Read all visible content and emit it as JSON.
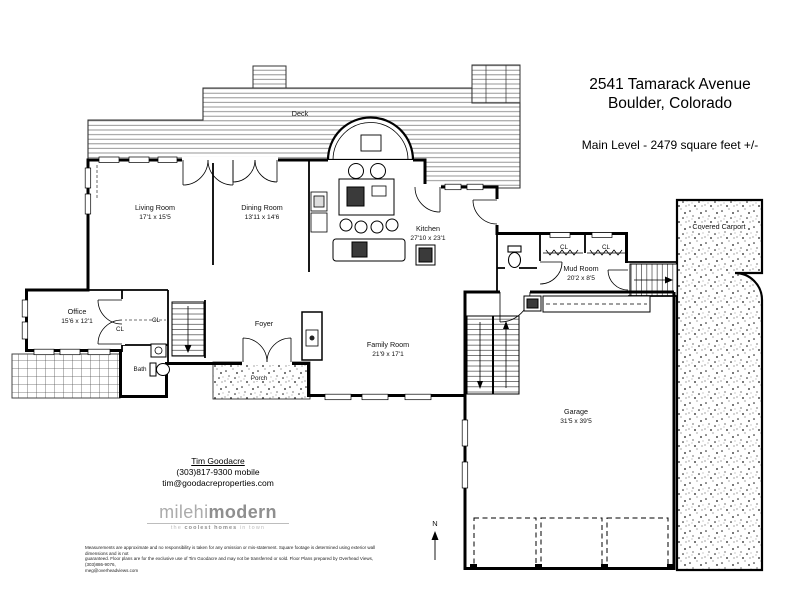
{
  "header": {
    "address_line1": "2541 Tamarack Avenue",
    "address_line2": "Boulder, Colorado",
    "level_label": "Main Level - 2479 square feet +/-"
  },
  "plan": {
    "deck_label": "Deck",
    "porch_label": "Porch",
    "foyer_label": "Foyer",
    "bath_label": "Bath",
    "closet_label": "CL",
    "carport_label": "Covered Carport",
    "north_label": "N",
    "rooms": {
      "living": {
        "name": "Living Room",
        "dims": "17'1 x 15'5"
      },
      "dining": {
        "name": "Dining Room",
        "dims": "13'11 x 14'6"
      },
      "kitchen": {
        "name": "Kitchen",
        "dims": "27'10 x 23'1"
      },
      "office": {
        "name": "Office",
        "dims": "15'6 x 12'1"
      },
      "family": {
        "name": "Family Room",
        "dims": "21'9 x 17'1"
      },
      "mud": {
        "name": "Mud Room",
        "dims": "20'2 x 8'5"
      },
      "garage": {
        "name": "Garage",
        "dims": "31'5 x 39'5"
      }
    }
  },
  "contact": {
    "agent_name": "Tim Goodacre",
    "phone": "(303)817-9300 mobile",
    "email": "tim@goodacreproperties.com"
  },
  "logo": {
    "brand_light": "milehi",
    "brand_bold": "modern",
    "tagline_pre": "the ",
    "tagline_bold": "coolest homes",
    "tagline_post": " in town"
  },
  "disclaimer": {
    "line1": "Measurements are approximate and no responsibility is taken for any omission or mis-statement.  Square footage is determined using exterior wall dimensions and is not",
    "line2": "guaranteed. Floor plans are for the exclusive use of Tim Goodacre and may not be transferred or sold. Floor Plans prepared by Overhead Views, (303)886-9076,",
    "line3": "meg@overheadviews.com"
  },
  "colors": {
    "wall": "#000000",
    "texture": "#555555",
    "logo_gray": "#9b9b9b"
  }
}
